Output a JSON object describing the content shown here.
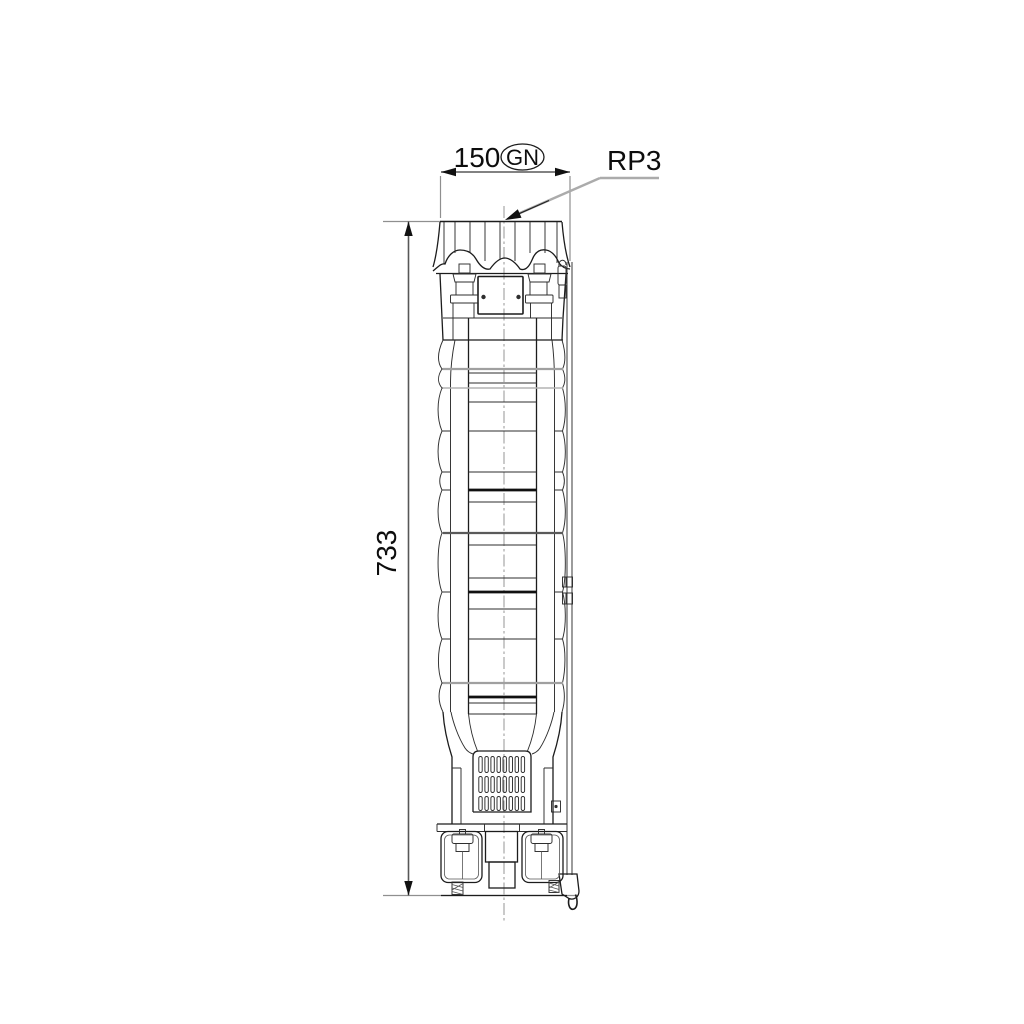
{
  "canvas": {
    "background": "#ffffff"
  },
  "annotations": {
    "width_dim": {
      "value": "150",
      "qualifier": "GN"
    },
    "height_dim": {
      "value": "733"
    },
    "port_label": {
      "text": "RP3"
    }
  },
  "colors": {
    "outline": "#1c1c1c",
    "dimension_line": "#585858",
    "extension_line": "#8f8f8f",
    "leader_line": "#ababab",
    "centerline": "#8a8a8a",
    "text": "#0d0d0d",
    "stage_joint_gray": "#a0a0a0",
    "stage_joint_dark": "#101010"
  }
}
